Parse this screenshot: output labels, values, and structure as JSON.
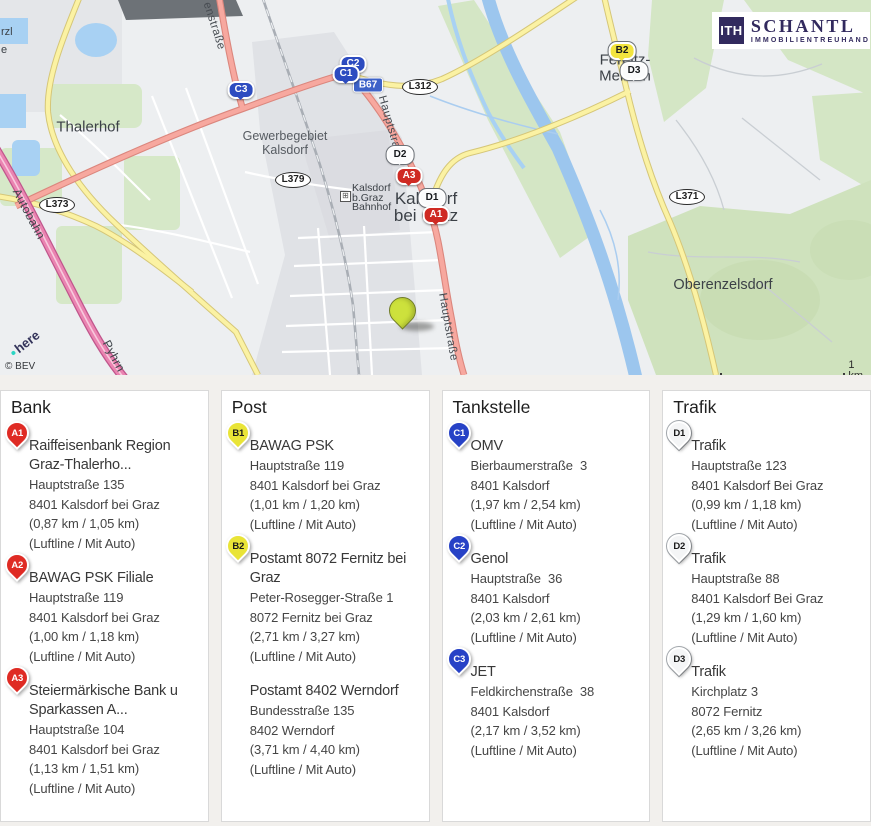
{
  "logo": {
    "monogram": "ITH",
    "name": "SCHANTL",
    "subtitle": "IMMOBILIENTREUHAND"
  },
  "map": {
    "attribution": "© BEV",
    "provider": "here",
    "scale": "1 km",
    "labels": {
      "thalerhof": "Thalerhof",
      "gewerbegebiet_1": "Gewerbegebiet",
      "gewerbegebiet_2": "Kalsdorf",
      "bahnhof_1": "Kalsdorf",
      "bahnhof_2": "b.Graz",
      "bahnhof_3": "Bahnhof",
      "kalsdorf_1": "Kalsdorf",
      "kalsdorf_2": "bei Graz",
      "fernitz_1": "Fernitz-",
      "fernitz_2": "Mellach",
      "oberenzelsdorf": "Oberenzelsdorf",
      "hauptstrasse_1": "Hauptstraße",
      "hauptstrasse_2": "Hauptstraße",
      "enstrasse": "enstraße",
      "pyhrn": "Pyhrn",
      "autobahn": "Autobahn",
      "edge_1": "rzl",
      "edge_2": "e"
    },
    "shields": {
      "l373": "L373",
      "l379": "L379",
      "b67": "B67",
      "l312": "L312",
      "l371": "L371"
    },
    "markers": {
      "a1": "A1",
      "a3": "A3",
      "b2": "B2",
      "c1": "C1",
      "c2": "C2",
      "c3": "C3",
      "d1": "D1",
      "d2": "D2",
      "d3": "D3"
    },
    "colors": {
      "marker_red": "#df2b24",
      "marker_yellow": "#e9e437",
      "marker_blue": "#2742c6",
      "marker_white": "#f4f5f6",
      "property_pin": "#cde13c",
      "brand_navy": "#322a5e",
      "water": "#9cc6ee",
      "forest": "#d4e6c5",
      "road_main": "#f7a89f",
      "motorway": "#ea84b1"
    }
  },
  "categories": [
    {
      "title": "Bank",
      "entries": [
        {
          "pin": "A1",
          "pin_color": "red",
          "name": "Raiffeisenbank Region Graz-Thalerho...",
          "lines": [
            "Hauptstraße 135",
            "8401 Kalsdorf bei Graz",
            "(0,87 km / 1,05 km)",
            "(Luftline / Mit Auto)"
          ]
        },
        {
          "pin": "A2",
          "pin_color": "red",
          "name": "BAWAG PSK Filiale",
          "lines": [
            "Hauptstraße 119",
            "8401 Kalsdorf bei Graz",
            "(1,00 km / 1,18 km)",
            "(Luftline / Mit Auto)"
          ]
        },
        {
          "pin": "A3",
          "pin_color": "red",
          "name": "Steiermärkische Bank u Sparkassen A...",
          "lines": [
            "Hauptstraße 104",
            "8401 Kalsdorf bei Graz",
            "(1,13 km / 1,51 km)",
            "(Luftline / Mit Auto)"
          ]
        }
      ]
    },
    {
      "title": "Post",
      "entries": [
        {
          "pin": "B1",
          "pin_color": "yellow",
          "name": "BAWAG PSK",
          "lines": [
            "Hauptstraße 119",
            "8401 Kalsdorf bei Graz",
            "(1,01 km / 1,20 km)",
            "(Luftline / Mit Auto)"
          ]
        },
        {
          "pin": "B2",
          "pin_color": "yellow",
          "name": "Postamt 8072 Fernitz bei Graz",
          "lines": [
            "Peter-Rosegger-Straße 1",
            "8072 Fernitz bei Graz",
            "(2,71 km / 3,27 km)",
            "(Luftline / Mit Auto)"
          ]
        },
        {
          "pin": "",
          "pin_color": "none",
          "name": "Postamt 8402 Werndorf",
          "lines": [
            "Bundesstraße 135",
            "8402 Werndorf",
            "(3,71 km / 4,40 km)",
            "(Luftline / Mit Auto)"
          ]
        }
      ]
    },
    {
      "title": "Tankstelle",
      "entries": [
        {
          "pin": "C1",
          "pin_color": "blue",
          "name": "OMV",
          "lines": [
            "Bierbaumerstraße  3",
            "8401 Kalsdorf",
            "(1,97 km / 2,54 km)",
            "(Luftline / Mit Auto)"
          ]
        },
        {
          "pin": "C2",
          "pin_color": "blue",
          "name": "Genol",
          "lines": [
            "Hauptstraße  36",
            "8401 Kalsdorf",
            "(2,03 km / 2,61 km)",
            "(Luftline / Mit Auto)"
          ]
        },
        {
          "pin": "C3",
          "pin_color": "blue",
          "name": "JET",
          "lines": [
            "Feldkirchenstraße  38",
            "8401 Kalsdorf",
            "(2,17 km / 3,52 km)",
            "(Luftline / Mit Auto)"
          ]
        }
      ]
    },
    {
      "title": "Trafik",
      "entries": [
        {
          "pin": "D1",
          "pin_color": "white",
          "name": "Trafik",
          "lines": [
            "Hauptstraße 123",
            "8401 Kalsdorf Bei Graz",
            "(0,99 km / 1,18 km)",
            "(Luftline / Mit Auto)"
          ]
        },
        {
          "pin": "D2",
          "pin_color": "white",
          "name": "Trafik",
          "lines": [
            "Hauptstraße 88",
            "8401 Kalsdorf Bei Graz",
            "(1,29 km / 1,60 km)",
            "(Luftline / Mit Auto)"
          ]
        },
        {
          "pin": "D3",
          "pin_color": "white",
          "name": "Trafik",
          "lines": [
            "Kirchplatz 3",
            "8072 Fernitz",
            "(2,65 km / 3,26 km)",
            "(Luftline / Mit Auto)"
          ]
        }
      ]
    }
  ]
}
